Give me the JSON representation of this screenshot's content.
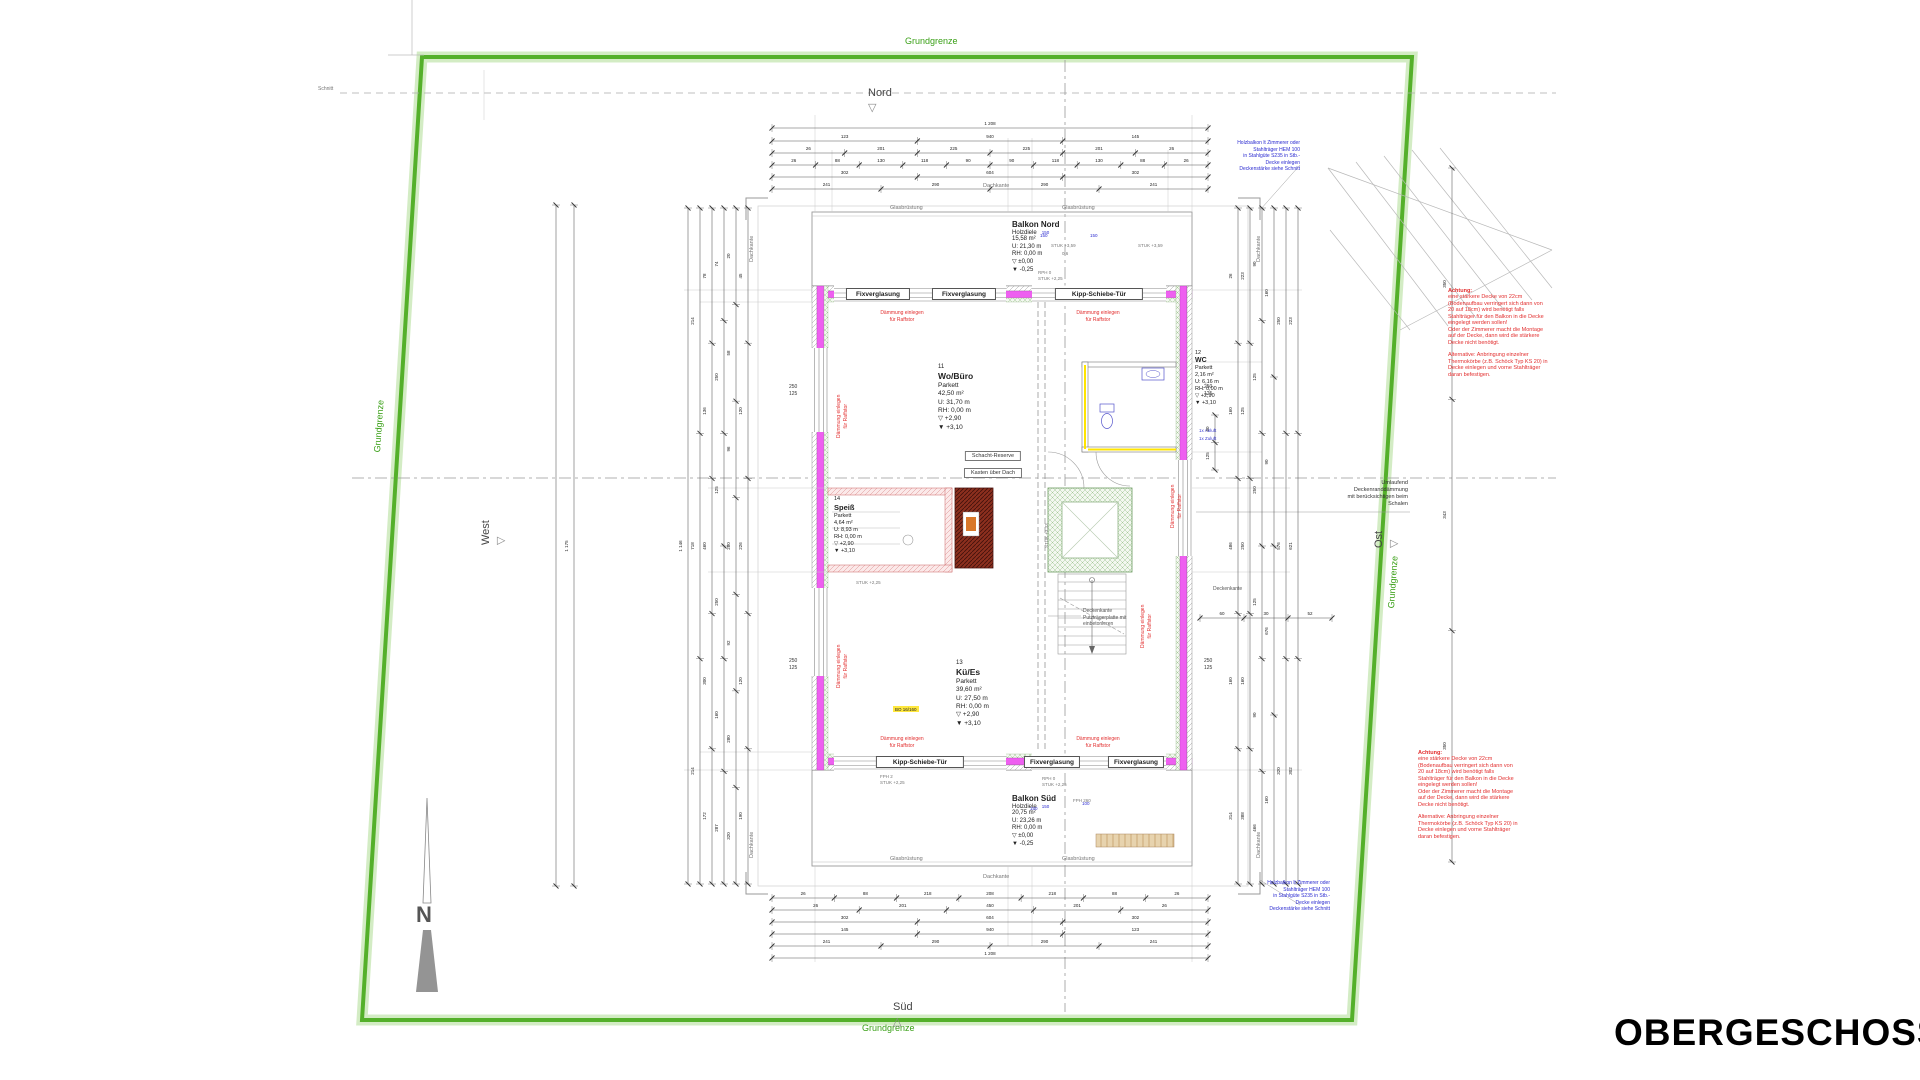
{
  "title": "OBERGESCHOSS",
  "boundary": {
    "label": "Grundgrenze"
  },
  "compass": {
    "north": "Nord",
    "south": "Süd",
    "west": "West",
    "east": "Ost",
    "arrow_letter": "N",
    "marker_down": "▽",
    "marker_up": "△"
  },
  "section": {
    "label": "Schnitt"
  },
  "rooms": {
    "balkon_nord": {
      "name": "Balkon Nord",
      "floor": "Holzdiele",
      "size": "150",
      "info": "15,58 m²\nU: 21,30 m\nRH: 0,00 m\n▽ ±0,00\n▼ -0,25"
    },
    "wo_buero": {
      "num": "11",
      "name": "Wo/Büro",
      "info": "Parkett\n42,50 m²\nU: 31,70 m\nRH: 0,00 m\n▽ +2,90\n▼ +3,10"
    },
    "wc": {
      "num": "12",
      "name": "WC",
      "info": "Parkett\n2,16 m²\nU: 6,16 m\nRH: 0,00 m\n▽ +2,90\n▼ +3,10"
    },
    "kue_es": {
      "num": "13",
      "name": "Kü/Es",
      "info": "Parkett\n39,60 m²\nU: 27,50 m\nRH: 0,00 m\n▽ +2,90\n▼ +3,10"
    },
    "speiss": {
      "num": "14",
      "name": "Speiß",
      "info": "Parkett\n4,64 m²\nU: 8,93 m\nRH: 0,00 m\n▽ +2,90\n▼ +3,10"
    },
    "balkon_sued": {
      "name": "Balkon Süd",
      "floor": "Holzdiele",
      "size": "150",
      "info": "20,75 m²\nU: 23,26 m\nRH: 0,00 m\n▽ ±0,00\n▼ -0,25"
    }
  },
  "windows": {
    "fix": "Fixverglasung",
    "kipp": "Kipp-Schiebe-Tür"
  },
  "notes": {
    "daemmung": "Dämmung einlegen\nfür Raffstor",
    "achtung_title": "Achtung:",
    "achtung_body": "eine stärkere Decke von 22cm\n(Bodenaufbau verringert sich dann von\n20 auf 18cm) wird benötigt falls\nStahlträger für den Balkon in die Decke\neingelegt werden sollen!\nOder der Zimmerer macht die Montage\nauf der Decke, dann wird die stärkere\nDecke nicht benötigt.",
    "achtung_alt": "Alternative: Anbringung einzelner\nThermokörbe (z.B. Schöck Typ KS 20) in\nDecke einlegen und vorne Stahlträger\ndaran befestigen.",
    "holzbalkon": "Holzbalkon lt Zimmerer oder\nStahlträger HEM 100\nin Stahlgüte S235 in Stb.-\nDecke einlegen\nDeckenstärke siehe Schnitt",
    "deckenrand": "Umlaufend\nDeckenranddämmung\nmit berücksichtigen beim\nSchalen",
    "deckenkante": "Deckenkante",
    "deckenkante_putz": "Deckenkante\nPutzträgerplatte mit\neinbetonieren",
    "dachkante": "Dachkante",
    "glasbruestung": "Glasbrüstung",
    "schacht_reserve": "Schacht-Reserve",
    "kasten": "Kasten über Dach",
    "abluft": "1x Abluft",
    "zuluft": "1x Zuluft",
    "bo": "BO 16/160",
    "rph_stuk": "RPH 0\nSTUK +2,25",
    "fph_stuk": "FPH 2\nSTUK +2,25",
    "stuk359": "STUK +3,59",
    "stuk359b": "0,6",
    "stuk333": "STUK +3,33",
    "stuk225": "STUK +2,25",
    "fph260": "FPH 260",
    "n150": "150",
    "n100": "100",
    "dim250": "250\n125"
  },
  "dimensions": {
    "chains": [
      [
        "1 208"
      ],
      [
        "123",
        "940",
        "145"
      ],
      [
        "26",
        "201",
        "225",
        "225",
        "201",
        "26"
      ],
      [
        "26",
        "88",
        "130",
        "118",
        "90",
        "90",
        "118",
        "130",
        "88",
        "26"
      ],
      [
        "302",
        "604",
        "302"
      ],
      [
        "241",
        "290",
        "290",
        "241"
      ],
      [
        "26",
        "88",
        "218",
        "208",
        "218",
        "88",
        "26"
      ],
      [
        "26",
        "201",
        "450",
        "201",
        "26"
      ],
      [
        "302",
        "604",
        "302"
      ],
      [
        "145",
        "940",
        "123"
      ],
      [
        "241",
        "290",
        "290",
        "241"
      ],
      [
        "1 208"
      ],
      [
        "1 146"
      ],
      [
        "214",
        "718",
        "214"
      ],
      [
        "78",
        "136",
        "460",
        "300",
        "172"
      ],
      [
        "74",
        "250",
        "125",
        "250",
        "160",
        "287"
      ],
      [
        "20",
        "58",
        "96",
        "280",
        "92",
        "280",
        "320"
      ],
      [
        "45",
        "120",
        "226",
        "120",
        "190"
      ],
      [],
      [
        "1 175"
      ],
      [
        "26",
        "160",
        "486",
        "160",
        "314"
      ],
      [
        "223",
        "125",
        "250",
        "160",
        "388"
      ],
      [
        "90",
        "125",
        "250",
        "125",
        "90",
        "466"
      ],
      [
        "160",
        "90",
        "676",
        "160"
      ],
      [
        "250",
        "576",
        "320"
      ],
      [
        "223",
        "621",
        "302"
      ],
      [
        "350",
        "343",
        "350"
      ],
      [
        "90",
        "125"
      ],
      [
        "60",
        "30",
        "52"
      ]
    ]
  }
}
